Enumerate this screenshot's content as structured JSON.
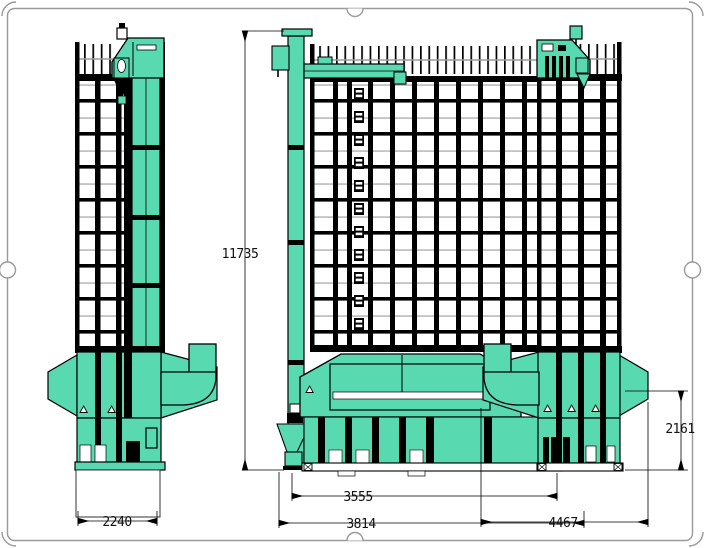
{
  "sheet": {
    "background": "#ffffff",
    "border_color": "#9a9a9a"
  },
  "colors": {
    "machine_green": "#58d9b0",
    "line_black": "#000000",
    "grid_gray": "#9b9b9b"
  },
  "drawing": {
    "subject": "grain-dryer-three-view-elevation",
    "views": [
      "left-side-elevation",
      "front-elevation",
      "right-side-elevation"
    ]
  },
  "dims": {
    "overall_height": "11735",
    "left_width": "2240",
    "front_width_inner": "3555",
    "front_width_overall": "3814",
    "right_width_overall": "4467",
    "lower_height": "2161"
  }
}
